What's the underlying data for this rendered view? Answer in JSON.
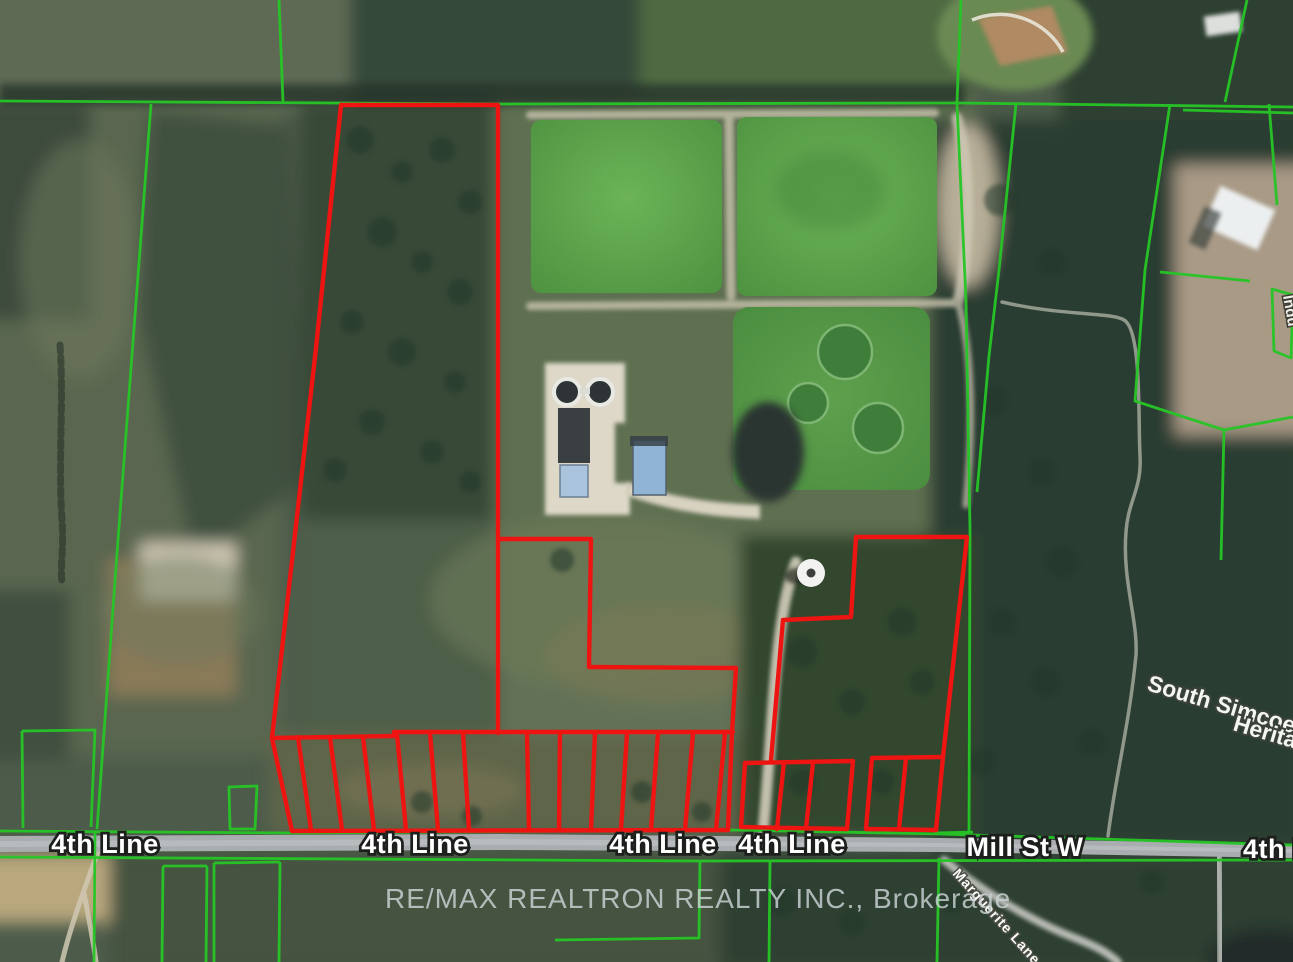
{
  "watermark": {
    "text": "RE/MAX REALTRON REALTY INC., Brokerage"
  },
  "roads": {
    "labels": [
      {
        "text": "4th Line"
      },
      {
        "text": "4th Line"
      },
      {
        "text": "4th Line"
      },
      {
        "text": "4th Line"
      },
      {
        "text": "Mill St W"
      },
      {
        "text": "4th Line"
      }
    ]
  },
  "places": {
    "area_label_line1": "South Simcoe",
    "area_label_line2": "Herita",
    "lane_label": "Marguerite Lane",
    "edge_label_partial": "Indu"
  },
  "colors": {
    "highlight_boundary": "#ee1411",
    "parcel_boundary": "#26c626",
    "road_fill": "#a9adb0",
    "watermark_text": "#ccd3d6"
  }
}
